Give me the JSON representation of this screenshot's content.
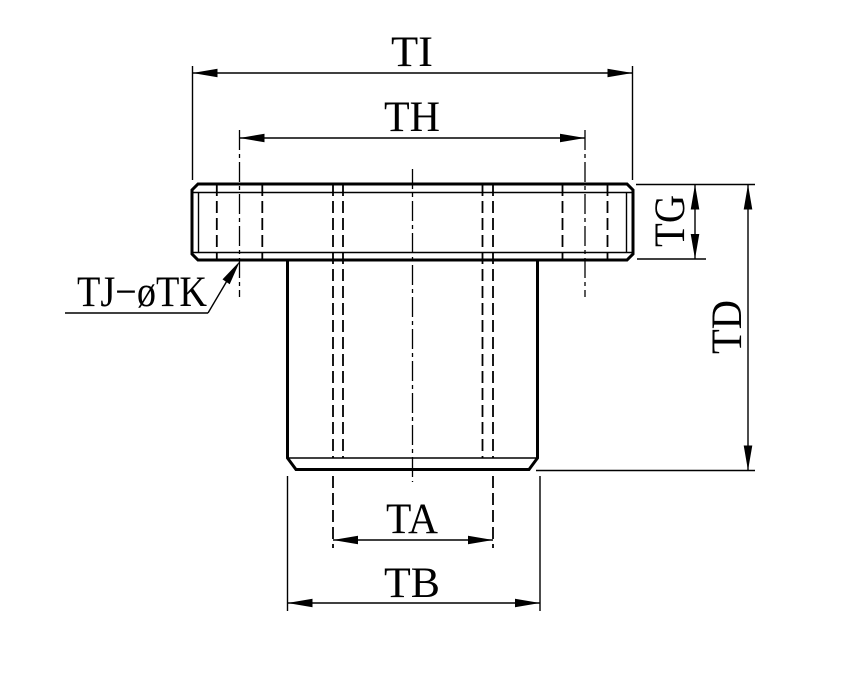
{
  "drawing": {
    "background_color": "#ffffff",
    "line_color": "#000000",
    "labels": {
      "flange_outer_diameter": "TI",
      "bolt_circle_diameter": "TH",
      "flange_thickness": "TG",
      "total_height": "TD",
      "inner_diameter": "TA",
      "body_diameter": "TB",
      "bolt_hole_note": "TJ−øTK"
    }
  }
}
